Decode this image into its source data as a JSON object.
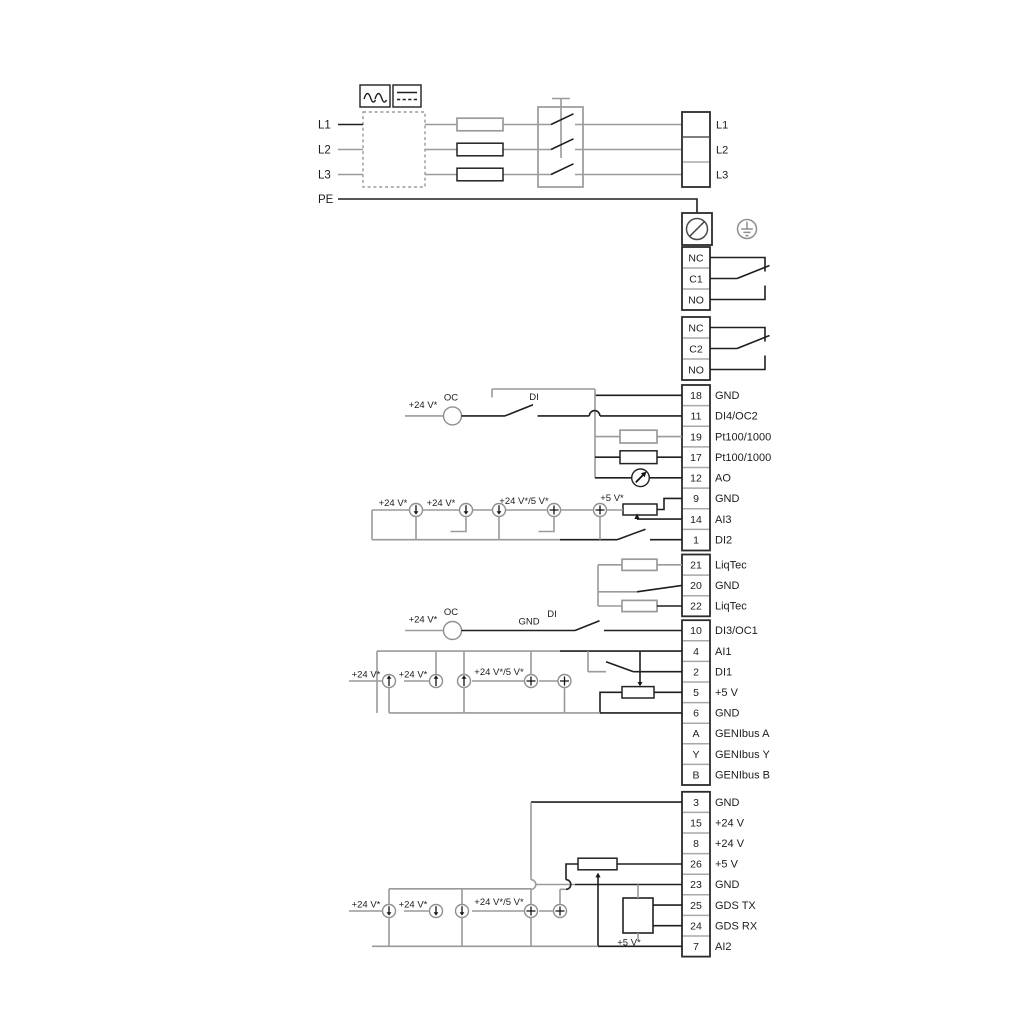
{
  "power": {
    "inputs": [
      "L1",
      "L2",
      "L3",
      "PE"
    ],
    "outputs": [
      "L1",
      "L2",
      "L3"
    ]
  },
  "relay1": [
    "NC",
    "C1",
    "NO"
  ],
  "relay2": [
    "NC",
    "C2",
    "NO"
  ],
  "io_top": [
    {
      "num": "18",
      "label": "GND"
    },
    {
      "num": "11",
      "label": "DI4/OC2"
    },
    {
      "num": "19",
      "label": "Pt100/1000"
    },
    {
      "num": "17",
      "label": "Pt100/1000"
    },
    {
      "num": "12",
      "label": "AO"
    },
    {
      "num": "9",
      "label": "GND"
    },
    {
      "num": "14",
      "label": "AI3"
    },
    {
      "num": "1",
      "label": "DI2"
    }
  ],
  "liqtec": [
    {
      "num": "21",
      "label": "LiqTec"
    },
    {
      "num": "20",
      "label": "GND"
    },
    {
      "num": "22",
      "label": "LiqTec"
    }
  ],
  "io_mid": [
    {
      "num": "10",
      "label": "DI3/OC1"
    },
    {
      "num": "4",
      "label": "AI1"
    },
    {
      "num": "2",
      "label": "DI1"
    },
    {
      "num": "5",
      "label": "+5 V"
    },
    {
      "num": "6",
      "label": "GND"
    },
    {
      "num": "A",
      "label": "GENIbus A"
    },
    {
      "num": "Y",
      "label": "GENIbus Y"
    },
    {
      "num": "B",
      "label": "GENIbus B"
    }
  ],
  "io_bottom": [
    {
      "num": "3",
      "label": "GND"
    },
    {
      "num": "15",
      "label": "+24 V"
    },
    {
      "num": "8",
      "label": "+24 V"
    },
    {
      "num": "26",
      "label": "+5 V"
    },
    {
      "num": "23",
      "label": "GND"
    },
    {
      "num": "25",
      "label": "GDS TX"
    },
    {
      "num": "24",
      "label": "GDS RX"
    },
    {
      "num": "7",
      "label": "AI2"
    }
  ],
  "ann": {
    "v24": "+24 V*",
    "v24_5": "+24 V*/5 V*",
    "v5": "+5 V*",
    "oc": "OC",
    "di": "DI",
    "gnd": "GND"
  },
  "colors": {
    "wire": "#1f1f1f",
    "wire_alt": "#9a9a9a"
  }
}
